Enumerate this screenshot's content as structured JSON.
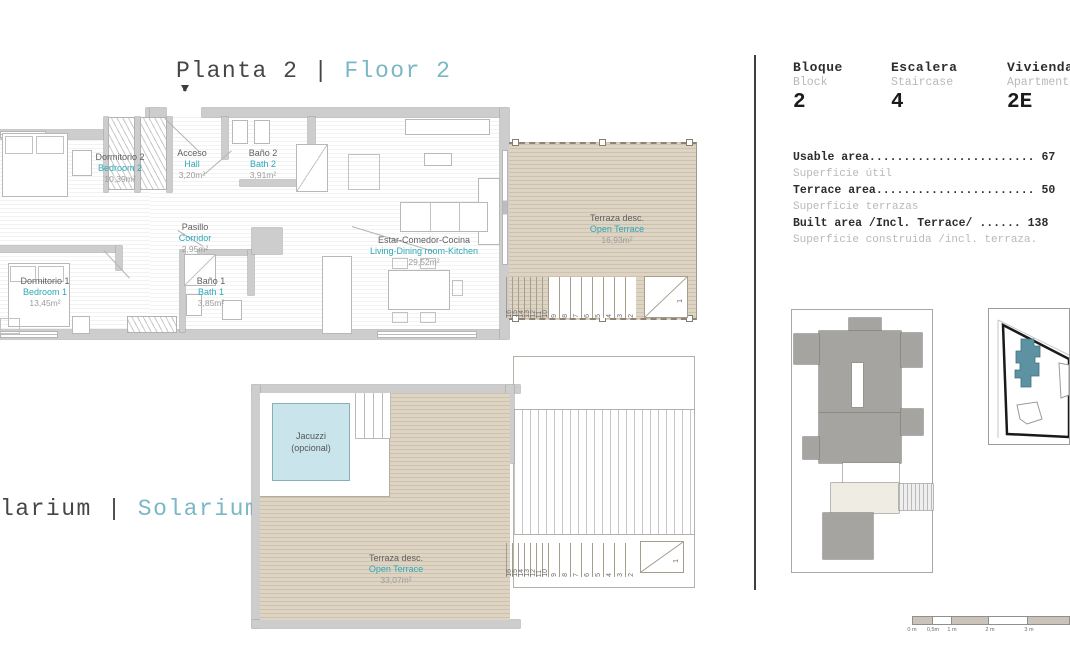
{
  "title": {
    "es": "Planta 2",
    "sep": "|",
    "en": "Floor 2"
  },
  "solarium_title": {
    "es_fragment": "larium",
    "sep": "|",
    "en": "Solarium"
  },
  "entrance_marker": "E",
  "rooms": {
    "bedroom2": {
      "es": "Dormitorio 2",
      "en": "Bedroom 2",
      "area": "10,39m²"
    },
    "hall": {
      "es": "Acceso",
      "en": "Hall",
      "area": "3,20m²"
    },
    "bath2": {
      "es": "Baño 2",
      "en": "Bath 2",
      "area": "3,91m²"
    },
    "corridor": {
      "es": "Pasillo",
      "en": "Corridor",
      "area": "2,95m²"
    },
    "bedroom1": {
      "es": "Dormitorio 1",
      "en": "Bedroom 1",
      "area": "13,45m²"
    },
    "bath1": {
      "es": "Baño 1",
      "en": "Bath 1",
      "area": "3,85m²"
    },
    "living": {
      "es": "Estar-Comedor-Cocina",
      "en": "Living-Dining room-Kitchen",
      "area": "29,52m²"
    },
    "terrace_floor2": {
      "es": "Terraza desc.",
      "en": "Open Terrace",
      "area": "16,93m²"
    },
    "terrace_solarium": {
      "es": "Terraza desc.",
      "en": "Open Terrace",
      "area": "33,07m²"
    },
    "jacuzzi": {
      "line1": "Jacuzzi",
      "line2": "(opcional)"
    }
  },
  "stairs": {
    "numbers": [
      "16",
      "15",
      "14",
      "13",
      "12",
      "11",
      "10",
      "9",
      "8",
      "7",
      "6",
      "5",
      "4",
      "3",
      "2"
    ],
    "last": "1",
    "narrow_count": 7
  },
  "info": {
    "columns": [
      {
        "es": "Bloque",
        "en": "Block",
        "value": "2"
      },
      {
        "es": "Escalera",
        "en": "Staircase",
        "value": "4"
      },
      {
        "es": "Vivienda",
        "en": "Apartment",
        "value": "2E"
      }
    ],
    "areas": [
      {
        "label": "Usable area",
        "dots": "........................ ",
        "value": "67",
        "sub": "Superficie útil"
      },
      {
        "label": "Terrace area",
        "dots": "....................... ",
        "value": "50",
        "sub": "Superficie terrazas"
      },
      {
        "label": "Built area /Incl. Terrace/",
        "dots": " ...... ",
        "value": "138",
        "sub": "Superficie construida /incl. terraza."
      }
    ]
  },
  "scale_bar": {
    "labels": [
      "0 m",
      "0,5m",
      "1 m",
      "2 m",
      "3 m"
    ]
  },
  "colors": {
    "teal_label": "#2da8b7",
    "teal_title": "#79b8c4",
    "dark_text": "#464646",
    "muted_text": "#9c9c9c",
    "panel_gray": "#b9b9b9",
    "wall": "#cdcdcd",
    "terrace_beige": "#ddd4c3",
    "jacuzzi_blue": "#c9e5eb",
    "site_building_teal": "#5d92a3"
  }
}
